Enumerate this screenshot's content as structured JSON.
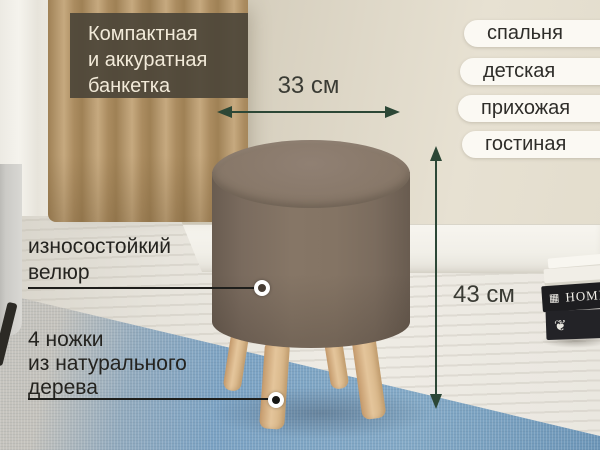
{
  "badge": {
    "line1": "Компактная",
    "line2": "и аккуратная",
    "line3": "банкетка"
  },
  "rooms": [
    {
      "label": "спальня"
    },
    {
      "label": "детская"
    },
    {
      "label": "прихожая"
    },
    {
      "label": "гостиная"
    }
  ],
  "measurements": {
    "width": "33 см",
    "height": "43 см"
  },
  "callout_velour": {
    "line1": "износостойкий",
    "line2": "велюр"
  },
  "callout_legs": {
    "line1": "4 ножки",
    "line2": "из натурального",
    "line3": "дерева"
  },
  "books": {
    "spine_title": "HOME",
    "stamp": "▦",
    "floral": "❦"
  },
  "colors": {
    "arrow": "#2c4736",
    "badge_bg": "rgba(76,69,56,0.92)",
    "stool_body": "#847464",
    "legs_wood": "#d9b68c",
    "rug_blue": "#7ba2c3",
    "pill_bg": "#fbf9f3"
  }
}
